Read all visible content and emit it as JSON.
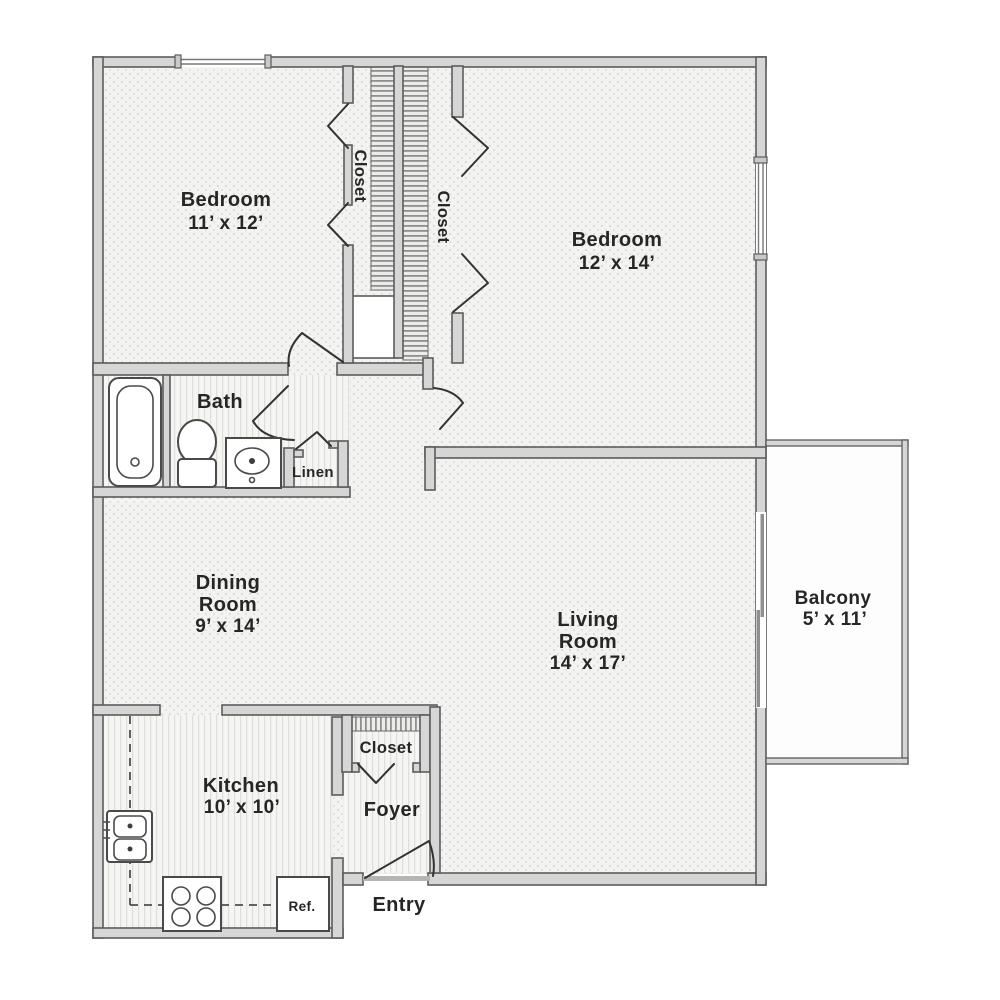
{
  "rooms": {
    "bedroom1": {
      "name": "Bedroom",
      "dims": "11’ x 12’"
    },
    "bedroom2": {
      "name": "Bedroom",
      "dims": "12’ x 14’"
    },
    "dining_room": {
      "line1": "Dining",
      "line2": "Room",
      "dims": "9’ x 14’"
    },
    "living_room": {
      "line1": "Living",
      "line2": "Room",
      "dims": "14’ x 17’"
    },
    "balcony": {
      "name": "Balcony",
      "dims": "5’ x 11’"
    },
    "kitchen": {
      "name": "Kitchen",
      "dims": "10’ x 10’"
    },
    "bath": {
      "name": "Bath"
    },
    "foyer": {
      "name": "Foyer"
    },
    "entry": {
      "name": "Entry"
    }
  },
  "closets": {
    "bedroom1_closet": {
      "label": "Closet"
    },
    "bedroom2_closet": {
      "label": "Closet"
    },
    "foyer_closet": {
      "label": "Closet"
    },
    "linen_closet": {
      "label": "Linen"
    }
  },
  "fixtures": {
    "refrigerator": {
      "label": "Ref."
    }
  },
  "colors": {
    "wall_fill": "#d6d6d6",
    "wall_outline": "#5c5c5c",
    "label_text": "#262626",
    "floor": "#f3f3f1",
    "hatch": "#8f8f8f",
    "background": "#ffffff"
  }
}
